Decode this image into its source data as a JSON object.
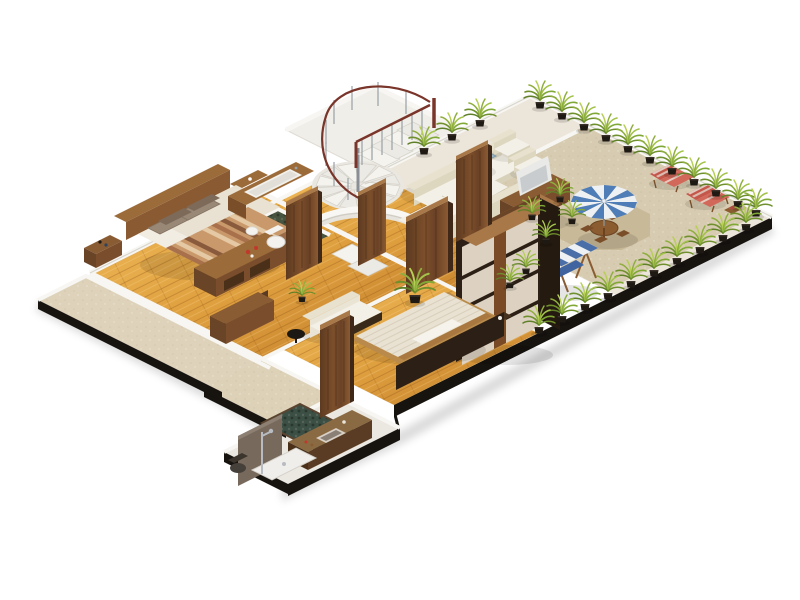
{
  "scene": {
    "type": "3d-isometric-floorplan-render",
    "setting": "apartment floor plan with rooftop terrace, rendered on white background",
    "rooms": [
      {
        "name": "rooftop-terrace",
        "floor": "sand beige paving",
        "items": [
          "blue and white striped parasol",
          "round wooden table with folding chairs",
          "two red plaid deck loungers",
          "canopy swing bench",
          "rows of potted palms in black pots"
        ]
      },
      {
        "name": "lounge",
        "floor": "pale cream tile",
        "items": [
          "two cream three-seat sofas",
          "two cream armchairs",
          "blue glass coffee table",
          "white tv on walnut media cabinet"
        ]
      },
      {
        "name": "stair-hall",
        "floor": "white",
        "items": [
          "white spiral staircase",
          "straight upper flight",
          "maroon handrail with grey balusters",
          "curved white wall"
        ]
      },
      {
        "name": "master-bedroom",
        "floor": "golden oak planks",
        "items": [
          "double bed with brown striped throw",
          "four brown pillows",
          "headboard wall",
          "nightstand",
          "storage bench with flowers",
          "dark dresser"
        ]
      },
      {
        "name": "ensuite-bathroom",
        "floor": "green pebble",
        "items": [
          "wooden vanity with white bathtub",
          "white toilet",
          "bidet"
        ]
      },
      {
        "name": "hallway",
        "floor": "golden oak planks",
        "items": [
          "standing walnut doors",
          "potted palm"
        ]
      },
      {
        "name": "second-bedroom",
        "floor": "golden oak planks",
        "items": [
          "low platform bed with ribbed cream mattress",
          "white pillows",
          "dark headboard wall",
          "white loveseat with wood base",
          "black round side table",
          "shoji wardrobe"
        ]
      },
      {
        "name": "main-bathroom",
        "floor": "white tile",
        "items": [
          "sunken green stone tub",
          "stone vanity with basin",
          "chrome shower column",
          "white shower tray",
          "dark toilet",
          "grey stone wall"
        ]
      },
      {
        "name": "balcony",
        "floor": "beige",
        "items": []
      },
      {
        "name": "patio-courtyard",
        "floor": "beige",
        "items": []
      }
    ],
    "counts": {
      "potted_plants": 32,
      "standing_doors": 5,
      "sofas": 3,
      "armchairs": 2,
      "beds": 2,
      "deck_loungers": 2,
      "parasols": 1
    }
  },
  "palette": {
    "background": "#ffffff",
    "platform_edge": "#17130f",
    "floor_white": "#f0eee8",
    "floor_living": "#ece5da",
    "floor_terrace": "#d7ccb1",
    "floor_paving": "#c8b998",
    "wood_light": "#eab34f",
    "wood_dark": "#c17c28",
    "pebble_green": "#47543f",
    "stone_green": "#3c4f44",
    "wall_white": "#f7f6f2",
    "walnut": "#6b4226",
    "walnut_light": "#8a5a32",
    "walnut_edge": "#a87848",
    "oak": "#9c6b3a",
    "cabinet_dark": "#2c1f15",
    "sofa_cream": "#e7e1cd",
    "cushion_white": "#f3f0e7",
    "umbrella_blue": "#4f7db8",
    "umbrella_white": "#eef1f4",
    "swing_blue": "#3f64a0",
    "plant_green": "#8fae3e",
    "plant_dark": "#5f8028",
    "pot_black": "#1e1913",
    "lounger_red": "#c4574a",
    "rail_maroon": "#7a352a",
    "metal_grey": "#9aa0a6",
    "pillow_brown": "#9a8876",
    "blanket_tan": "#c9996c",
    "mattress_cream": "#e9e2d2",
    "tv_white": "#e9e9e7",
    "shoji_panel": "#ddd2c2",
    "glass_blue": "#9fb8c8",
    "vanity_stone": "#8a6a42",
    "wall_grey": "#77695c"
  }
}
